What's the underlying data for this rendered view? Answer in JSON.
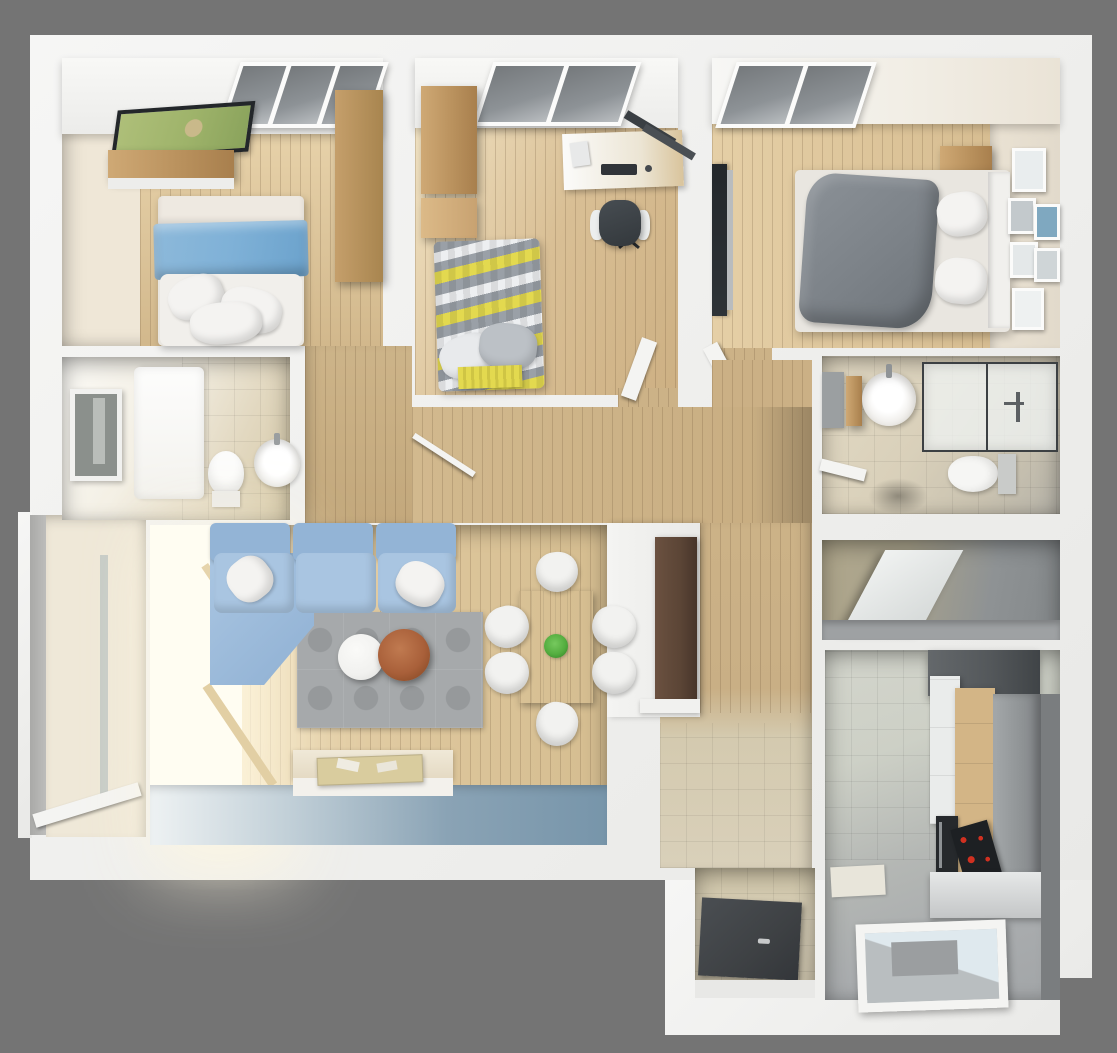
{
  "palette": {
    "canvas_bg": "#747474",
    "wall_white": "#f3f3f1",
    "beige_wall": "#ece3d1",
    "beige_tile": "#ded3ba",
    "balcony_floor": "#efe8d8",
    "hall_wood": "#ccb287",
    "plank_line": "#6e55383b",
    "sofa_blue": "#a9c5e1",
    "sofa_blue_deep": "#93b4d6",
    "pillow_white": "#f4f3f1",
    "blanket_blue": "#7fb1d7",
    "duvet_white": "#f1efeb",
    "mattress": "#e9e6e0",
    "blanket_gray": "#7c8288",
    "chevron_yellow": "#e3d94f",
    "chevron_gray": "#9aa0a7",
    "chevron_white": "#edeff1",
    "rug_gray": "#a6a9ab",
    "rug_circle": "#96999b",
    "table_copper": "#a9603a",
    "table_white": "#f1f1ef",
    "dining_wood": "#dcc9a4",
    "plant_green": "#54ad3f",
    "south_wall_blue": "#7795aa",
    "window_glow": "#fffdf2",
    "skylight_glass": "#75797c",
    "tv_dark": "#2e3337",
    "tv_picture_green": "#9eb36a",
    "door_brown": "#5b4536",
    "shower_tray": "#3e4144",
    "cooktop_red": "#d03020",
    "cabinet_gray": "#9b9fa1",
    "cabinet_dark": "#54585b",
    "cabinet_white": "#eaeceb",
    "kitchen_wood": "#d3b586",
    "kitchen_floor": "#a9acae",
    "kitchen_tile": "#cdd0c6",
    "glass_blue": "#dfe9ee",
    "storage_olive": "#b0a78c",
    "storage_gray": "#8e9294",
    "picture_blue": "#7fa8c0",
    "chair_white": "#f2f2f0"
  }
}
